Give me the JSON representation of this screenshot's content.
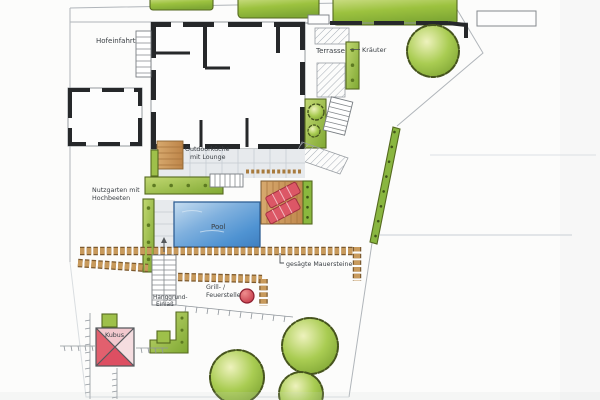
{
  "plan": {
    "kind": "hand-drawn garden landscape plan (scan)",
    "labels": {
      "hofeinfahrt": "Hofeinfahrt",
      "terrasse": "Terrasse",
      "kraeuter": "Kräuter",
      "outdoorkueche_line1": "Outdoorküche",
      "outdoorkueche_line2": "mit Lounge",
      "nutzgarten_line1": "Nutzgarten mit",
      "nutzgarten_line2": "Hochbeeten",
      "pool": "Pool",
      "mauersteine": "gesägte Mauersteine",
      "grill_line1": "Grill- /",
      "grill_line2": "Feuerstelle",
      "hang_line1": "Hanggrund-",
      "hang_line2": "Einlaß",
      "kubus": "Kubus"
    },
    "colors": {
      "ink": "#3a3f44",
      "wall_black": "#26282a",
      "hedge_green": "#9cc23f",
      "bed_green": "#9ec04a",
      "pool_blue": "#4f93d2",
      "deck_tan": "#c9935a",
      "stone_brown": "#c89a5c",
      "lounger_red": "#dc5766",
      "firepit_red": "#d44556",
      "kubus_red": "#e2606e",
      "paving_gray": "#e7eaed",
      "boundary_gray": "#b0b5ba"
    }
  }
}
